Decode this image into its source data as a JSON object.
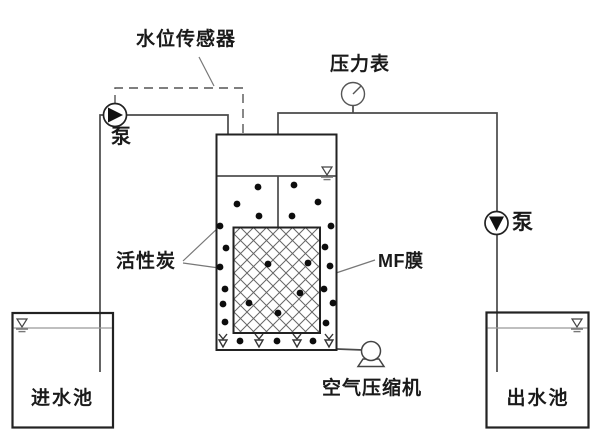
{
  "diagram": {
    "type": "process-flow-schematic",
    "components": [
      {
        "id": "inlet_tank",
        "label": "进水池"
      },
      {
        "id": "pump_left",
        "label": "泵"
      },
      {
        "id": "water_level_sensor",
        "label": "水位传感器"
      },
      {
        "id": "bioreactor_tank",
        "label": ""
      },
      {
        "id": "activated_carbon",
        "label": "活性炭"
      },
      {
        "id": "mf_membrane",
        "label": "MF膜"
      },
      {
        "id": "air_compressor",
        "label": "空气压缩机"
      },
      {
        "id": "pressure_gauge",
        "label": "压力表"
      },
      {
        "id": "pump_right",
        "label": "泵"
      },
      {
        "id": "outlet_tank",
        "label": "出水池"
      }
    ]
  },
  "labels": {
    "water_level_sensor": "水位传感器",
    "pressure_gauge": "压力表",
    "pump_left": "泵",
    "pump_right": "泵",
    "activated_carbon": "活性炭",
    "mf_membrane": "MF膜",
    "air_compressor": "空气压缩机",
    "inlet_tank": "进水池",
    "outlet_tank": "出水池"
  },
  "colors": {
    "background": "#ffffff",
    "pipe_line": "#4a4a4a",
    "tank_outline": "#222222",
    "dot_fill": "#0d0d0d",
    "hatch_line": "#666666",
    "leader_line": "#777777",
    "text": "#1a1a1a"
  },
  "icons": {
    "pump_left": "pump-circle-filled-triangle-right",
    "pump_right": "pump-circle-filled-triangle-down",
    "pressure_gauge": "dial-gauge-with-needle",
    "air_compressor": "circle-on-pedestal",
    "water_surface": "inverted-triangle-over-hatches",
    "level_sensor_probe": "small-open-rectangle",
    "aerator": "v-arrow-nozzle"
  }
}
